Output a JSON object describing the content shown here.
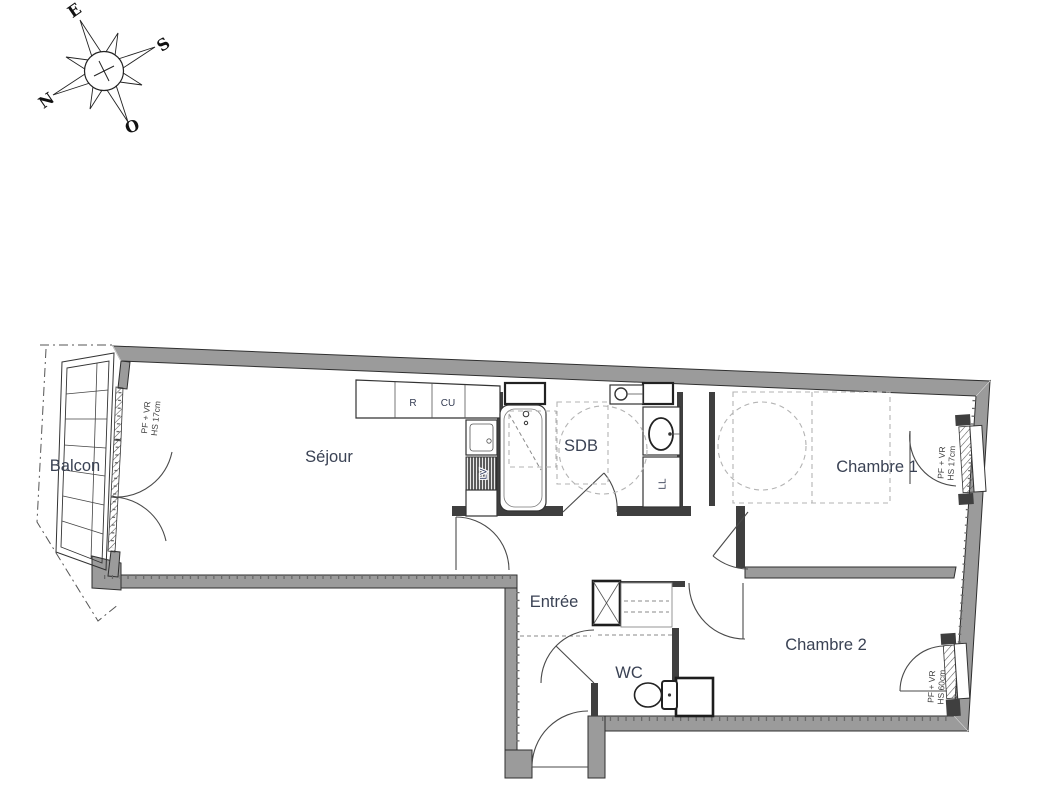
{
  "plan_title": "Floor plan",
  "rooms": {
    "balcon": "Balcon",
    "sejour": "Séjour",
    "sdb": "SDB",
    "entree": "Entrée",
    "wc": "WC",
    "chambre1": "Chambre 1",
    "chambre2": "Chambre 2"
  },
  "appliances": {
    "fridge": "R",
    "cooktop": "CU",
    "dishwasher": "LV",
    "washing_machine": "LL"
  },
  "windows": {
    "balcony_door": {
      "l1": "PF + VR",
      "l2": "HS  17cm"
    },
    "chambre1_window": {
      "l1": "PF + VR",
      "l2": "HS  17cm"
    },
    "chambre2_window": {
      "l1": "PF + VR",
      "l2": "HS  60cm"
    }
  },
  "compass": {
    "n": "N",
    "s": "S",
    "e": "E",
    "o": "O"
  },
  "colors": {
    "exterior_wall": "#9b9b9b",
    "partition": "#3f3f3f",
    "outline": "#2f2f2f",
    "room_label": "#3a4254",
    "dashed_guides": "#b3b3b3",
    "paper": "#ffffff"
  }
}
